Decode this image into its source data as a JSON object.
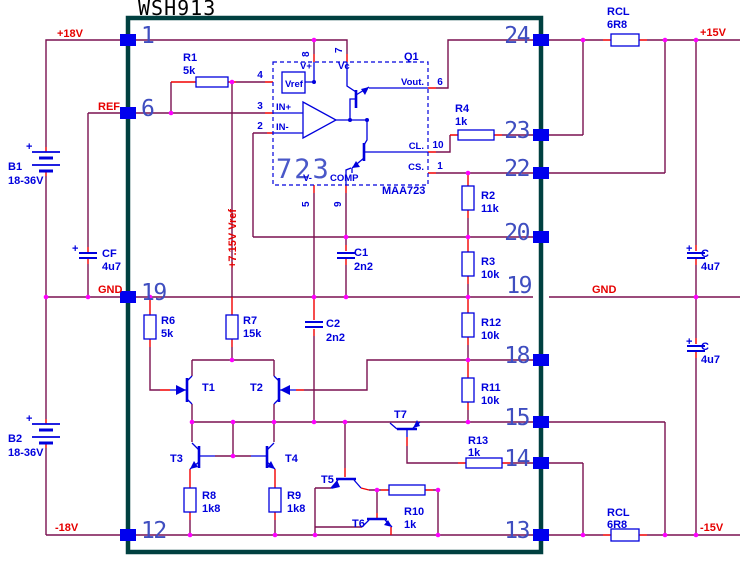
{
  "title": "WSH913",
  "colors": {
    "wire": "#7a1150",
    "lead": "#f20000",
    "component": "#0000dd",
    "pin_square": "#0000ee",
    "junction_dot": "#ff00ff",
    "border": "#004040",
    "pin_number": "#3f4ec0",
    "rail_label": "#e60000"
  },
  "rails": {
    "p18": "+18V",
    "ref": "REF",
    "gnd_left": "GND",
    "m18": "-18V",
    "p15": "+15V",
    "gnd_right": "GND",
    "m15": "-15V",
    "vref_rail": "+7.15V Vref"
  },
  "pins_left": [
    "1",
    "6",
    "19",
    "12"
  ],
  "pins_right": [
    "24",
    "23",
    "22",
    "20",
    "19",
    "18",
    "15",
    "14",
    "13"
  ],
  "batteries": [
    {
      "ref": "B1",
      "value": "18-36V",
      "plus": "+"
    },
    {
      "ref": "B2",
      "value": "18-36V",
      "plus": "+"
    }
  ],
  "ic": {
    "big_label": "723",
    "part": "MAA723",
    "designator": "Q1",
    "vref_box": "Vref",
    "pin_labels": {
      "vplus": "V+",
      "vc": "Vc",
      "vminus": "V-",
      "comp": "COMP",
      "in_plus": "IN+",
      "in_minus": "IN-",
      "vout": "Vout.",
      "cl": "CL.",
      "cs": "CS."
    },
    "pin_numbers": {
      "n8": "8",
      "n7": "7",
      "n5": "5",
      "n9": "9",
      "n4": "4",
      "n3": "3",
      "n2": "2",
      "n6": "6",
      "n10": "10",
      "n1": "1"
    }
  },
  "resistors": [
    {
      "ref": "R1",
      "value": "5k"
    },
    {
      "ref": "R4",
      "value": "1k"
    },
    {
      "ref": "R2",
      "value": "11k"
    },
    {
      "ref": "R3",
      "value": "10k"
    },
    {
      "ref": "R12",
      "value": "10k"
    },
    {
      "ref": "R11",
      "value": "10k"
    },
    {
      "ref": "R13",
      "value": "1k"
    },
    {
      "ref": "RCL",
      "value": "6R8"
    },
    {
      "ref": "RCL",
      "value": "6R8"
    },
    {
      "ref": "R6",
      "value": "5k"
    },
    {
      "ref": "R7",
      "value": "15k"
    },
    {
      "ref": "R8",
      "value": "1k8"
    },
    {
      "ref": "R9",
      "value": "1k8"
    },
    {
      "ref": "R10",
      "value": "1k"
    }
  ],
  "capacitors": [
    {
      "ref": "CF",
      "value": "4u7",
      "plus": "+"
    },
    {
      "ref": "C1",
      "value": "2n2"
    },
    {
      "ref": "C2",
      "value": "2n2"
    },
    {
      "ref": "C",
      "value": "4u7",
      "plus": "+"
    },
    {
      "ref": "C",
      "value": "4u7",
      "plus": "+"
    }
  ],
  "transistors": [
    "T1",
    "T2",
    "T3",
    "T4",
    "T5",
    "T6",
    "T7"
  ]
}
